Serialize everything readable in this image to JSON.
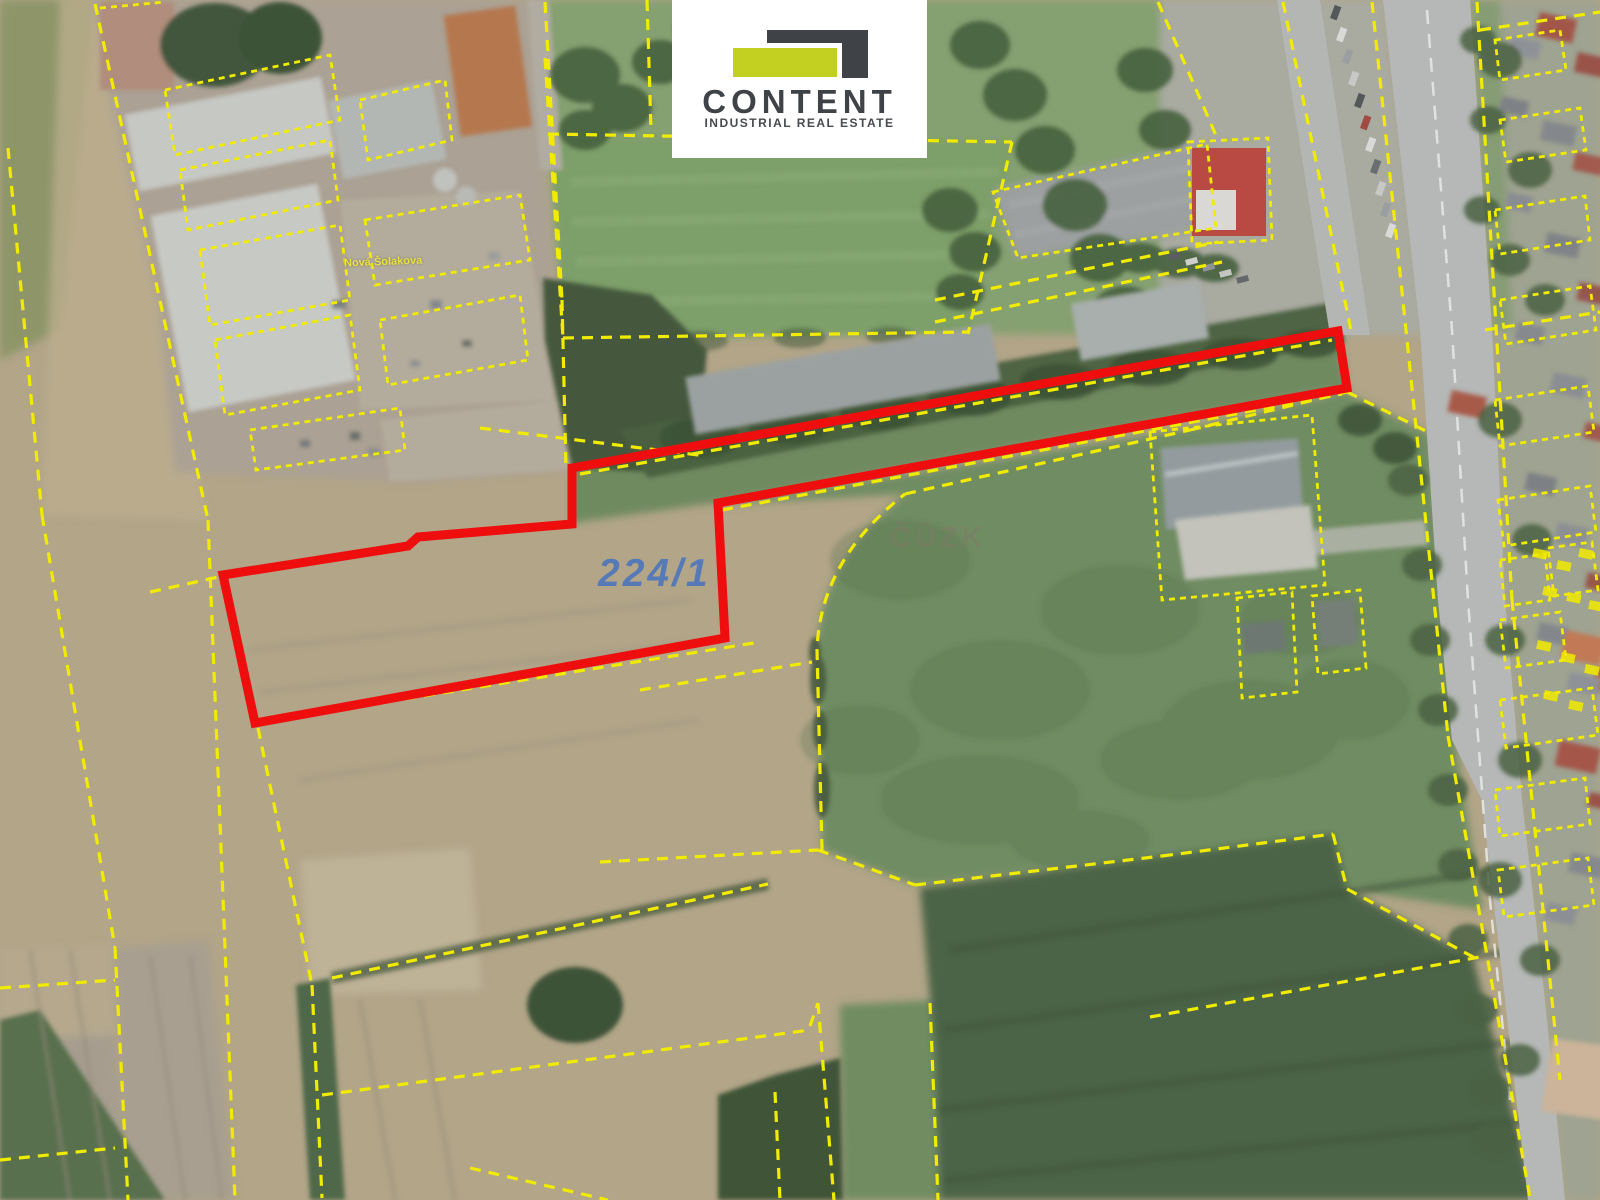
{
  "branding": {
    "logo_text": "CONTENT",
    "logo_subtext": "INDUSTRIAL REAL ESTATE",
    "colors": {
      "logo_dark": "#3f4347",
      "logo_lime": "#c3cf21",
      "logo_background": "#ffffff"
    }
  },
  "map": {
    "parcel_label": "224/1",
    "parcel_label_color": "#3e6ec4",
    "watermark_label": "ČÚZK",
    "street_label": "Nová Šolakova",
    "highlight_outline_color": "#ee0e0e",
    "cadastre_line_color": "#f1eb00",
    "highlight_outline_points": "223,575 408,546 418,537 572,524 572,468 1338,331 1347,388 718,503 725,638 255,723"
  }
}
